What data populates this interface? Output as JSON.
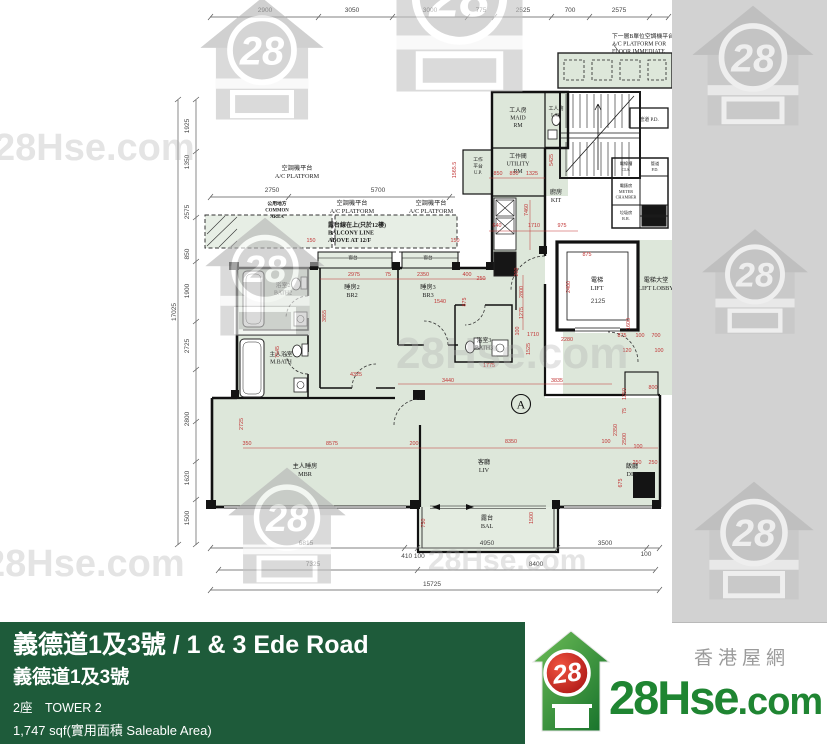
{
  "watermark": {
    "text": "28Hse.com",
    "logo_number": "28"
  },
  "colors": {
    "banner_green": "#1e5b3a",
    "brand_green": "#1f8532",
    "brand_red": "#c8251d",
    "plan_room_green": "#dde7da",
    "dim_red": "#c13434",
    "scan_margin_gray": "#d2d2d2"
  },
  "footer": {
    "title": "義德道1及3號 / 1 & 3 Ede Road",
    "subtitle": "義德道1及3號",
    "tower": "2座　TOWER 2",
    "area": "1,747 sqf(實用面積 Saleable Area)"
  },
  "brand": {
    "logo_number": "28",
    "name_main": "28Hse",
    "name_tld": ".com",
    "tagline": "香港屋網"
  },
  "plan": {
    "unit_mark": "A",
    "labels": [
      {
        "x": 297,
        "y": 170,
        "s": 6.2,
        "a": "m",
        "lines": [
          "空調機平台",
          "A/C PLATFORM"
        ]
      },
      {
        "x": 352,
        "y": 205,
        "s": 6.2,
        "a": "m",
        "lines": [
          "空調機平台",
          "A/C PLATFORM"
        ]
      },
      {
        "x": 431,
        "y": 205,
        "s": 6.2,
        "a": "m",
        "lines": [
          "空調機平台",
          "A/C PLATFORM"
        ]
      },
      {
        "x": 277,
        "y": 205,
        "s": 4.8,
        "b": 1,
        "a": "m",
        "lines": [
          "公用地方",
          "COMMON",
          "AREA"
        ]
      },
      {
        "x": 328,
        "y": 227,
        "s": 6,
        "b": 1,
        "a": "s",
        "lines": [
          "露台線在上(只於12樓)",
          "BALCONY LINE",
          "ABOVE AT 12/F"
        ]
      },
      {
        "x": 612,
        "y": 38,
        "s": 5.8,
        "a": "s",
        "lines": [
          "下一層B單位空調機平台",
          "A/C PLATFORM FOR",
          "FLOOR IMMEDIATE"
        ]
      },
      {
        "x": 518,
        "y": 112,
        "s": 5.8,
        "a": "m",
        "lines": [
          "工人房",
          "MAID",
          "RM"
        ]
      },
      {
        "x": 556,
        "y": 110,
        "s": 5,
        "a": "m",
        "lines": [
          "工人廁",
          "LAV"
        ]
      },
      {
        "x": 518,
        "y": 158,
        "s": 5.8,
        "a": "m",
        "lines": [
          "工作間",
          "UTILITY",
          "RM"
        ]
      },
      {
        "x": 478,
        "y": 161,
        "s": 4.8,
        "a": "m",
        "lines": [
          "工作",
          "平台",
          "U.P."
        ]
      },
      {
        "x": 556,
        "y": 194,
        "s": 6.2,
        "a": "m",
        "lines": [
          "廚房",
          "KIT"
        ]
      },
      {
        "x": 283,
        "y": 287,
        "s": 5.8,
        "a": "m",
        "lines": [
          "浴室2",
          "BATH2"
        ]
      },
      {
        "x": 281,
        "y": 356,
        "s": 5.8,
        "a": "m",
        "lines": [
          "主人浴室",
          "M.BATH"
        ]
      },
      {
        "x": 352,
        "y": 289,
        "s": 6.2,
        "a": "m",
        "lines": [
          "睡房2",
          "BR2"
        ]
      },
      {
        "x": 428,
        "y": 289,
        "s": 6.2,
        "a": "m",
        "lines": [
          "睡房3",
          "BR3"
        ]
      },
      {
        "x": 484,
        "y": 342,
        "s": 5.8,
        "a": "m",
        "lines": [
          "浴室3",
          "BATH3"
        ]
      },
      {
        "x": 597,
        "y": 282,
        "s": 6.2,
        "a": "m",
        "lines": [
          "電梯",
          "LIFT"
        ]
      },
      {
        "x": 656,
        "y": 282,
        "s": 6.2,
        "a": "m",
        "lines": [
          "電梯大堂",
          "LIFT LOBBY"
        ]
      },
      {
        "x": 305,
        "y": 468,
        "s": 6.2,
        "a": "m",
        "lines": [
          "主人睡房",
          "MBR"
        ]
      },
      {
        "x": 484,
        "y": 464,
        "s": 6.2,
        "a": "m",
        "lines": [
          "客廳",
          "LIV"
        ]
      },
      {
        "x": 632,
        "y": 468,
        "s": 6.2,
        "a": "m",
        "lines": [
          "飯廳",
          "DIN"
        ]
      },
      {
        "x": 487,
        "y": 520,
        "s": 6.2,
        "a": "m",
        "lines": [
          "露台",
          "BAL"
        ]
      },
      {
        "x": 353,
        "y": 259,
        "s": 4.6,
        "a": "m",
        "lines": [
          "窗台"
        ]
      },
      {
        "x": 428,
        "y": 259,
        "s": 4.6,
        "a": "m",
        "lines": [
          "窗台"
        ]
      },
      {
        "x": 649,
        "y": 121,
        "s": 5,
        "a": "m",
        "lines": [
          "管道 P.D."
        ]
      },
      {
        "x": 626,
        "y": 165,
        "s": 4.2,
        "a": "m",
        "lines": [
          "電線槽",
          "CLS."
        ]
      },
      {
        "x": 655,
        "y": 165,
        "s": 4.2,
        "a": "m",
        "lines": [
          "管道",
          "P.D."
        ]
      },
      {
        "x": 626,
        "y": 187,
        "s": 4.2,
        "a": "m",
        "lines": [
          "電錶房",
          "METER",
          "CHAMBER"
        ]
      },
      {
        "x": 626,
        "y": 214,
        "s": 4.2,
        "a": "m",
        "lines": [
          "垃圾房",
          "R.R."
        ]
      }
    ],
    "dims": [
      [
        "2900",
        265,
        12,
        "g"
      ],
      [
        "3050",
        352,
        12,
        "g"
      ],
      [
        "3000",
        430,
        12,
        "g"
      ],
      [
        "775",
        481,
        12,
        "g"
      ],
      [
        "2525",
        523,
        12,
        "g"
      ],
      [
        "700",
        570,
        12,
        "g"
      ],
      [
        "2575",
        619,
        12,
        "g"
      ],
      [
        "2750",
        272,
        192,
        "g"
      ],
      [
        "5700",
        378,
        192,
        "g"
      ],
      [
        "1925",
        189,
        126,
        "gr"
      ],
      [
        "1350",
        189,
        162,
        "gr"
      ],
      [
        "2575",
        189,
        212,
        "gr"
      ],
      [
        "850",
        189,
        254,
        "gr"
      ],
      [
        "1900",
        189,
        291,
        "gr"
      ],
      [
        "2725",
        189,
        346,
        "gr"
      ],
      [
        "2800",
        189,
        419,
        "gr"
      ],
      [
        "1620",
        189,
        478,
        "gr"
      ],
      [
        "1500",
        189,
        518,
        "gr"
      ],
      [
        "17025",
        176,
        312,
        "gr"
      ],
      [
        "6815",
        306,
        545,
        "g"
      ],
      [
        "410 100",
        413,
        558,
        "g"
      ],
      [
        "4950",
        487,
        545,
        "g"
      ],
      [
        "3500",
        605,
        545,
        "g"
      ],
      [
        "100",
        646,
        556,
        "g"
      ],
      [
        "7325",
        313,
        566,
        "g"
      ],
      [
        "8400",
        536,
        566,
        "g"
      ],
      [
        "15725",
        432,
        586,
        "g"
      ],
      [
        "850",
        498,
        175
      ],
      [
        "850",
        514,
        175
      ],
      [
        "1325",
        532,
        175
      ],
      [
        "640",
        497,
        227
      ],
      [
        "1710",
        534,
        227
      ],
      [
        "975",
        562,
        227
      ],
      [
        "7460",
        528,
        210,
        "r"
      ],
      [
        "1565.5",
        456,
        170,
        "r"
      ],
      [
        "5425",
        553,
        160,
        "r"
      ],
      [
        "2975",
        354,
        276
      ],
      [
        "75",
        388,
        276
      ],
      [
        "2350",
        423,
        276
      ],
      [
        "400",
        467,
        276
      ],
      [
        "250",
        481,
        280
      ],
      [
        "150",
        311,
        242
      ],
      [
        "150",
        455,
        242
      ],
      [
        "875",
        466,
        302,
        "r"
      ],
      [
        "3855",
        326,
        316,
        "r"
      ],
      [
        "7545",
        279,
        352,
        "r"
      ],
      [
        "4325",
        356,
        376
      ],
      [
        "1540",
        440,
        303
      ],
      [
        "1775",
        489,
        367
      ],
      [
        "3440",
        448,
        382
      ],
      [
        "3835",
        557,
        382
      ],
      [
        "200",
        518,
        272,
        "r"
      ],
      [
        "2800",
        523,
        292,
        "r"
      ],
      [
        "1275",
        523,
        313,
        "r"
      ],
      [
        "100",
        519,
        331,
        "r"
      ],
      [
        "1710",
        533,
        336
      ],
      [
        "1525",
        530,
        349,
        "r"
      ],
      [
        "2280",
        567,
        341
      ],
      [
        "875",
        587,
        256
      ],
      [
        "2400",
        570,
        287,
        "r"
      ],
      [
        "1600",
        630,
        324,
        "r"
      ],
      [
        "875",
        622,
        337
      ],
      [
        "100",
        640,
        337
      ],
      [
        "700",
        656,
        337
      ],
      [
        "120",
        627,
        352
      ],
      [
        "100",
        659,
        352
      ],
      [
        "800",
        653,
        389
      ],
      [
        "1250",
        626,
        394,
        "r"
      ],
      [
        "75",
        626,
        411,
        "r"
      ],
      [
        "2500",
        626,
        439,
        "r"
      ],
      [
        "100",
        638,
        448
      ],
      [
        "250",
        637,
        464
      ],
      [
        "250",
        653,
        464
      ],
      [
        "675",
        622,
        483,
        "r"
      ],
      [
        "350",
        247,
        445
      ],
      [
        "8575",
        332,
        445
      ],
      [
        "200",
        414,
        445
      ],
      [
        "8350",
        511,
        443
      ],
      [
        "100",
        606,
        443
      ],
      [
        "2350",
        617,
        430,
        "r"
      ],
      [
        "2725",
        243,
        424,
        "r"
      ],
      [
        "1500",
        533,
        518,
        "r"
      ],
      [
        "750",
        425,
        523,
        "r"
      ],
      [
        "2125",
        598,
        303,
        "g"
      ]
    ]
  }
}
